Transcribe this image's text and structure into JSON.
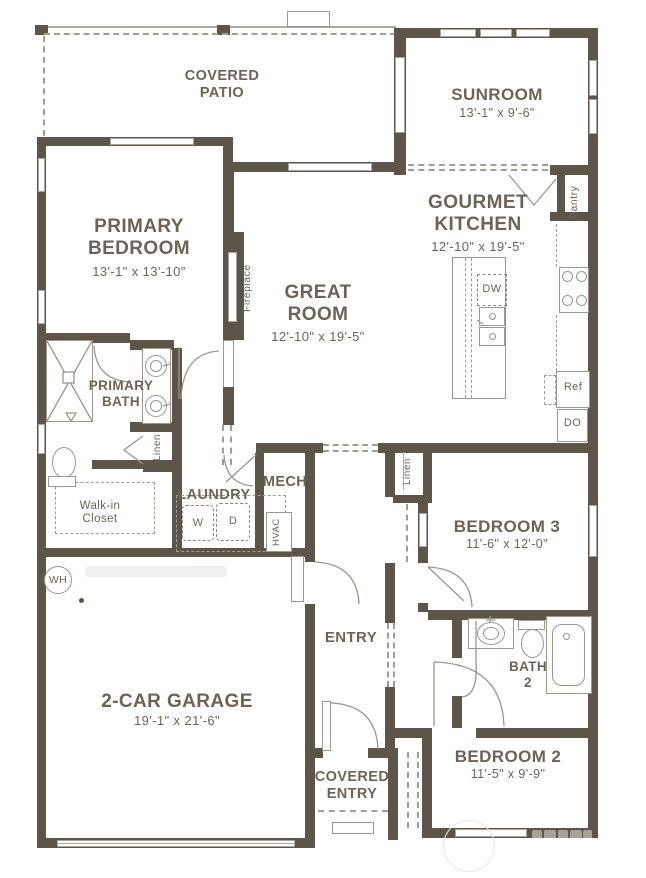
{
  "colors": {
    "wall": "#5d5548",
    "thin_line": "#9d968b",
    "dashed_line": "#a39c91",
    "text": "#6e6355",
    "background": "#ffffff"
  },
  "rooms": {
    "covered_patio": {
      "name": "COVERED\nPATIO"
    },
    "sunroom": {
      "name": "SUNROOM",
      "dims": "13'-1\" x 9'-6\""
    },
    "primary_bedroom": {
      "name": "PRIMARY\nBEDROOM",
      "dims": "13'-1\" x 13'-10\""
    },
    "gourmet_kitchen": {
      "name": "GOURMET\nKITCHEN",
      "dims": "12'-10\" x 19'-5\""
    },
    "great_room": {
      "name": "GREAT\nROOM",
      "dims": "12'-10\" x 19'-5\""
    },
    "primary_bath": {
      "name": "PRIMARY\nBATH"
    },
    "walk_in_closet": {
      "name": "Walk-in\nCloset"
    },
    "laundry": {
      "name": "LAUNDRY"
    },
    "mech": {
      "name": "MECH"
    },
    "entry": {
      "name": "ENTRY"
    },
    "bedroom_3": {
      "name": "BEDROOM 3",
      "dims": "11'-6\" x 12'-0\""
    },
    "bath_2": {
      "name": "BATH\n2"
    },
    "bedroom_2": {
      "name": "BEDROOM 2",
      "dims": "11'-5\" x 9'-9\""
    },
    "garage": {
      "name": "2-CAR GARAGE",
      "dims": "19'-1\" x 21'-6\""
    },
    "covered_entry": {
      "name": "COVERED\nENTRY"
    }
  },
  "fixtures": {
    "fireplace": "Fireplace",
    "pantry": "Pantry",
    "dishwasher": "DW",
    "refrigerator": "Ref",
    "double_oven": "DO",
    "linen_bath": "Linen",
    "linen_hall": "Linen",
    "washer": "W",
    "dryer": "D",
    "hvac": "HVAC",
    "water_heater": "WH"
  }
}
